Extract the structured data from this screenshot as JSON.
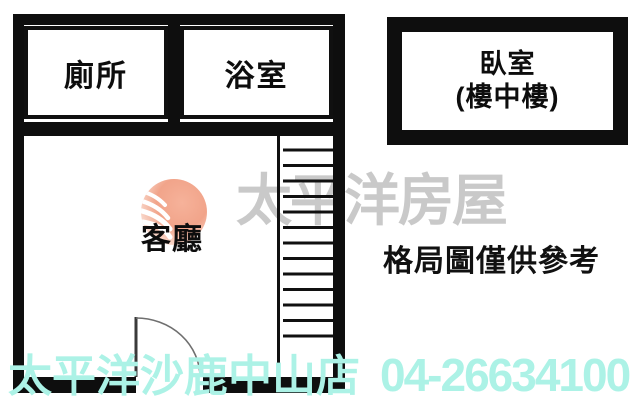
{
  "plan": {
    "toilet_label": "廁所",
    "bathroom_label": "浴室",
    "living_label": "客廳",
    "bedroom_label_line1": "臥室",
    "bedroom_label_line2": "(樓中樓)"
  },
  "watermark": {
    "brand": "太平洋房屋"
  },
  "note": {
    "disclaimer": "格局圖僅供參考"
  },
  "footer": {
    "store": "太平洋沙鹿中山店",
    "phone": "04-26634100"
  },
  "icons": {
    "logo": "pacific-realty-sphere-logo",
    "door": "door-swing-arc",
    "stairs": "staircase"
  },
  "colors": {
    "wall_black": "#0e0e0e",
    "watermark_gray": "#c9c9c9",
    "footer_cyan": "#acf2e6",
    "logo_salmon": "#f2a78d",
    "background": "#ffffff"
  }
}
